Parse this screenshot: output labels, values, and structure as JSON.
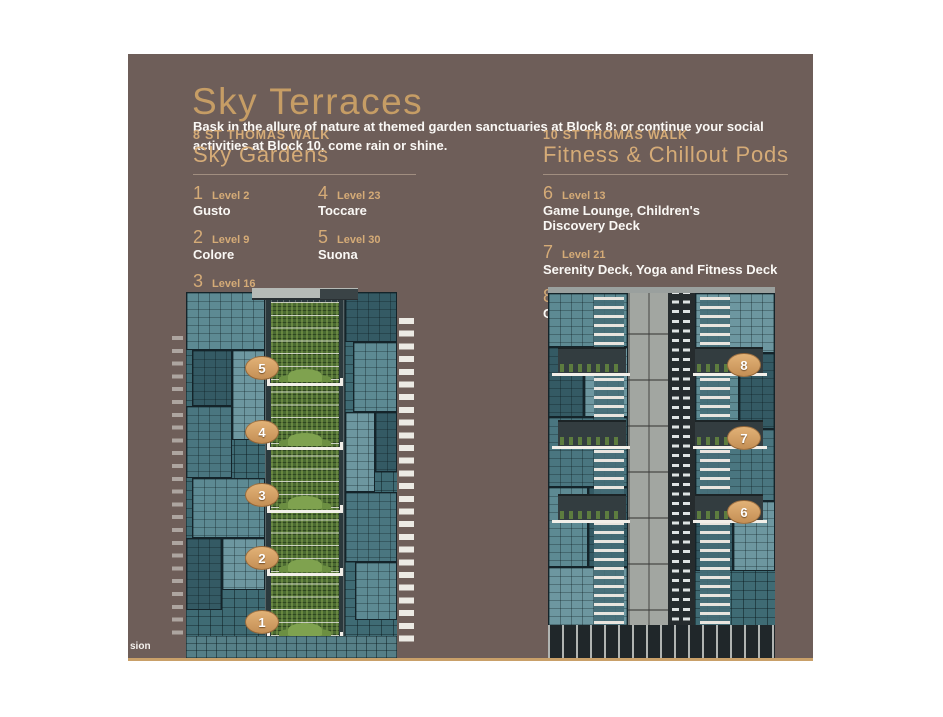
{
  "header": {
    "title": "Sky Terraces",
    "intro": "Bask in the allure of nature at themed garden sanctuaries at Block 8; or continue your social activities at Block 10, come rain or shine."
  },
  "sky_gardens": {
    "block_label": "8 ST THOMAS WALK",
    "heading": "Sky Gardens",
    "items": [
      {
        "num": "1",
        "level": "Level 2",
        "name": "Gusto"
      },
      {
        "num": "2",
        "level": "Level 9",
        "name": "Colore"
      },
      {
        "num": "3",
        "level": "Level 16",
        "name": "Profumo"
      },
      {
        "num": "4",
        "level": "Level 23",
        "name": "Toccare"
      },
      {
        "num": "5",
        "level": "Level 30",
        "name": "Suona"
      }
    ]
  },
  "fitness_pods": {
    "block_label": "10 ST THOMAS WALK",
    "heading": "Fitness & Chillout Pods",
    "items": [
      {
        "num": "6",
        "level": "Level 13",
        "name": "Game Lounge, Children's\nDiscovery Deck"
      },
      {
        "num": "7",
        "level": "Level 21",
        "name": "Serenity Deck, Yoga and Fitness Deck"
      },
      {
        "num": "8",
        "level": "Level 29",
        "name": "Cocktail Lounge, Gourmet Dining"
      }
    ]
  },
  "illustrations": {
    "left_building_markers": [
      "5",
      "4",
      "3",
      "2",
      "1"
    ],
    "right_building_markers": [
      "8",
      "7",
      "6"
    ],
    "caption_fragment": "sion"
  },
  "colors": {
    "panel_brown": "#6e5e59",
    "accent_gold": "#c9a069",
    "heading_tan": "#d5ab77",
    "marker_fill": "#d8a76b",
    "glass_teal": "#41707a",
    "garden_green": "#4a6a31",
    "text_white": "#faf8f5"
  }
}
